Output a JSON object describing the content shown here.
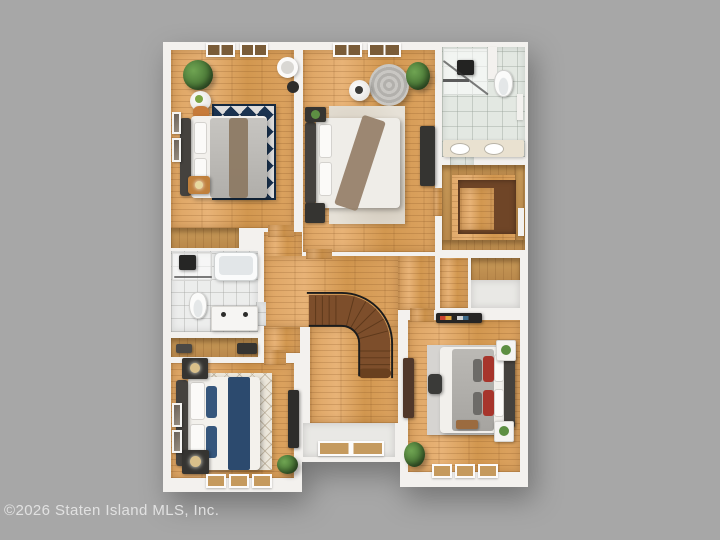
{
  "watermark": {
    "text": "©2026 Staten Island MLS, Inc."
  },
  "scene": {
    "type": "3d-rendered real-estate floor plan, top-down view",
    "subject": "upper floor with three bedrooms, two bathrooms, walk-in closet, linen closets, hallway and curved staircase",
    "background": "plain gray"
  },
  "palette": {
    "background": "#a7a7a7",
    "wall": "#f3f1ee",
    "wood_floor": "#dda462",
    "shelf_wood": "#c89a58",
    "stair_wood": "#7d4e2b",
    "tile_green": "#e3e8e2",
    "tile_white": "#ecedec",
    "rug_navy": "#1b3350",
    "rug_cream": "#ece7db",
    "rug_beige": "#e6e1d7",
    "rug_gray": "#d6d4d1",
    "accent_navy": "#2c4a6e",
    "accent_red": "#a7352c",
    "plant_green": "#4c7a38",
    "dark_furniture": "#353431",
    "white_furniture": "#f5f4f2"
  },
  "rooms": [
    {
      "id": "bedroom-top-left",
      "type": "bedroom",
      "features": [
        "double bed with gray duvet and brown throw",
        "navy-and-white geometric triangle rug",
        "round wood side table with fruit",
        "orange pouf",
        "wood nightstand",
        "potted plant",
        "two top windows",
        "wall art",
        "round wall mirror",
        "dark pendant"
      ]
    },
    {
      "id": "bedroom-top-middle",
      "type": "bedroom",
      "features": [
        "double bed with white duvet and brown throw",
        "round gray lounge chair",
        "white side table",
        "potted plant",
        "dark media console",
        "beige area rug",
        "two dark nightstands",
        "two top windows"
      ]
    },
    {
      "id": "bathroom-top-right",
      "type": "bathroom",
      "features": [
        "walk-in shower with glass panel",
        "toilet",
        "double-sink vanity",
        "green tile floor",
        "door"
      ]
    },
    {
      "id": "walk-in-closet-right",
      "type": "closet",
      "features": [
        "perimeter wood shelving",
        "dark lower platform"
      ]
    },
    {
      "id": "closet-a",
      "type": "closet",
      "features": [
        "wood floor"
      ]
    },
    {
      "id": "closet-b",
      "type": "closet",
      "features": [
        "wood shelf"
      ]
    },
    {
      "id": "linen-closet-top",
      "type": "closet",
      "features": [
        "wood shelf"
      ]
    },
    {
      "id": "bathroom-middle-left",
      "type": "bathroom",
      "features": [
        "shower",
        "bathtub",
        "toilet",
        "double vanity",
        "white tile floor"
      ]
    },
    {
      "id": "linen-closet-bottom",
      "type": "closet",
      "features": [
        "wood shelf",
        "dark storage items"
      ]
    },
    {
      "id": "bedroom-bottom-left",
      "type": "bedroom",
      "features": [
        "double bed with white duvet and navy runner",
        "cream diamond-lattice rug",
        "two dark nightstands with lamps",
        "dark console table",
        "potted plant",
        "three bottom windows",
        "wall art"
      ]
    },
    {
      "id": "bedroom-bottom-right",
      "type": "bedroom",
      "features": [
        "double bed with gray duvet and red pillows",
        "gray area rug",
        "two white nightstands with plants",
        "dark dresser",
        "dark wall shelf with books",
        "stool",
        "wood bench",
        "potted plant",
        "three bottom windows"
      ]
    },
    {
      "id": "hallway",
      "type": "hallway",
      "features": [
        "curved dark-wood staircase with black railing",
        "white landing with window"
      ]
    }
  ]
}
